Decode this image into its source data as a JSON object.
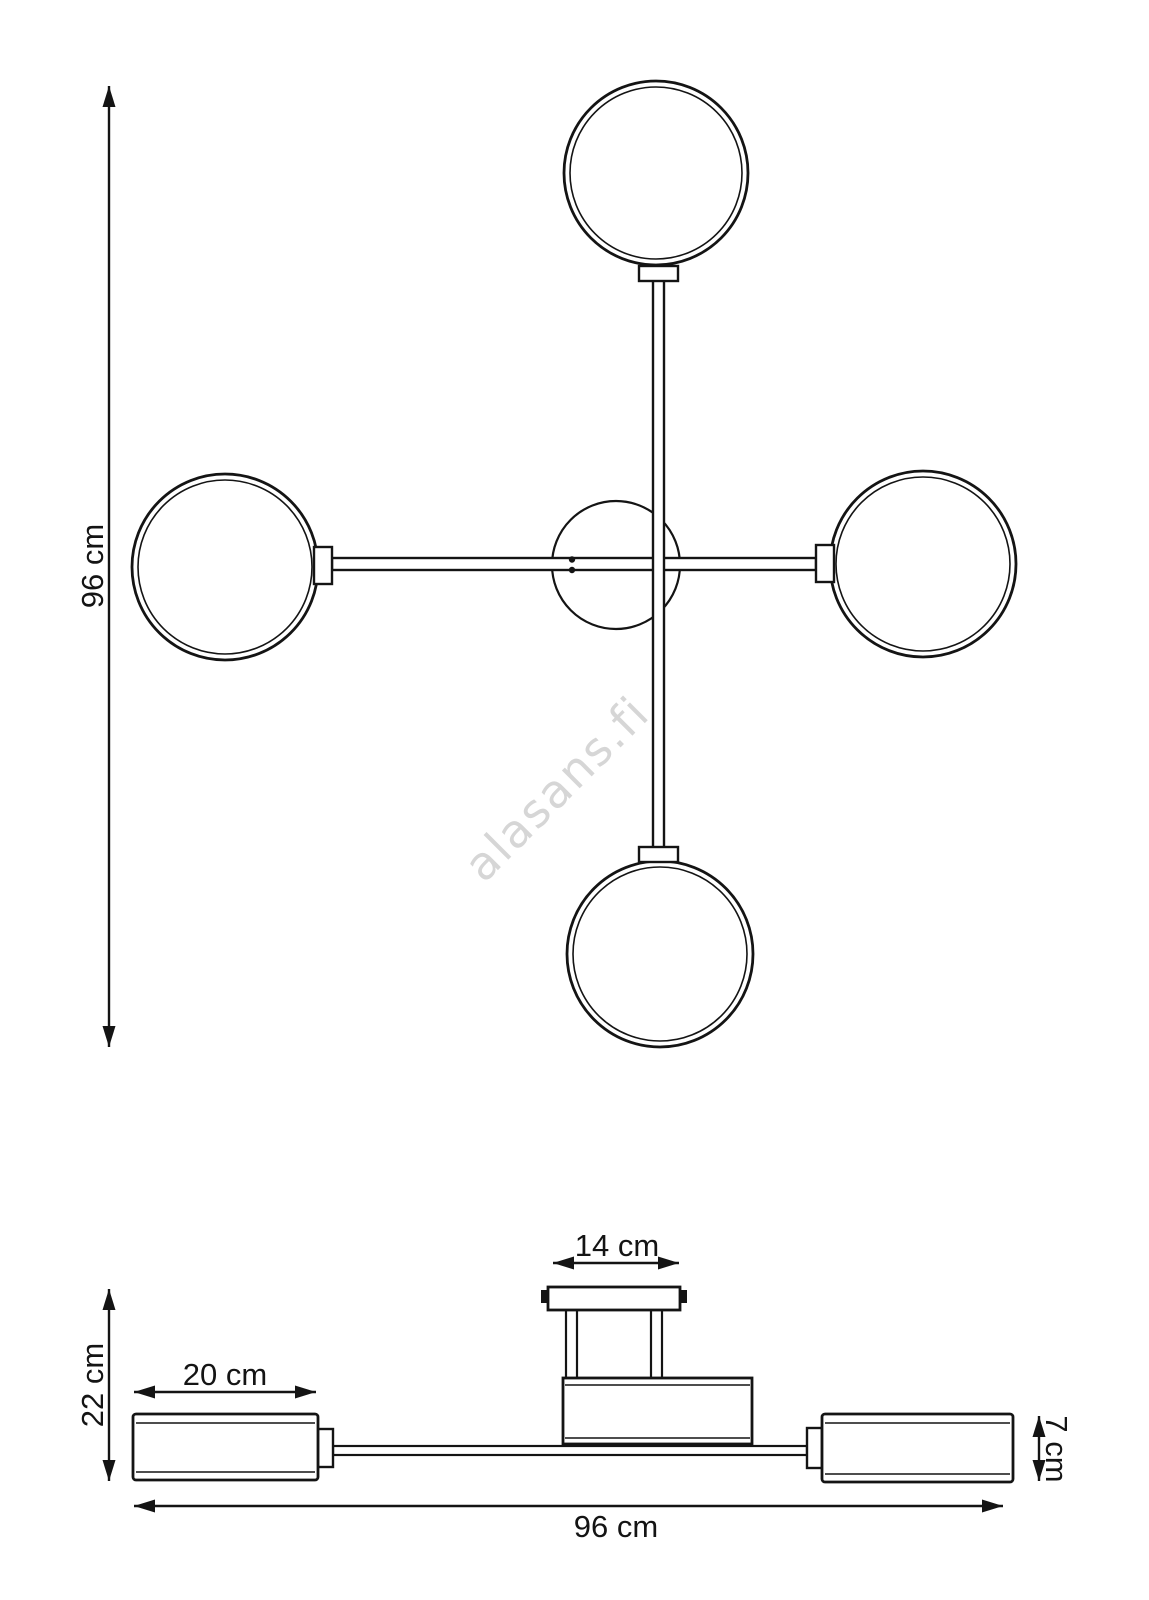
{
  "page": {
    "background_color": "#ffffff",
    "line_color": "#141414",
    "watermark": {
      "text": "alasans.fi",
      "color": "#d6d6d6"
    }
  },
  "top_view": {
    "description": "plan view of 5-light ceiling lamp: four double-line globes on cross arms around central canopy circle",
    "labels": {
      "height": "96 cm"
    }
  },
  "side_view": {
    "description": "side elevation: ceiling plate with two posts, central body, horizontal arm with two cylindrical shades",
    "labels": {
      "canopy_width": "14 cm",
      "drop_height": "22 cm",
      "shade_length": "20 cm",
      "shade_height": "7 cm",
      "total_width": "96 cm"
    }
  }
}
